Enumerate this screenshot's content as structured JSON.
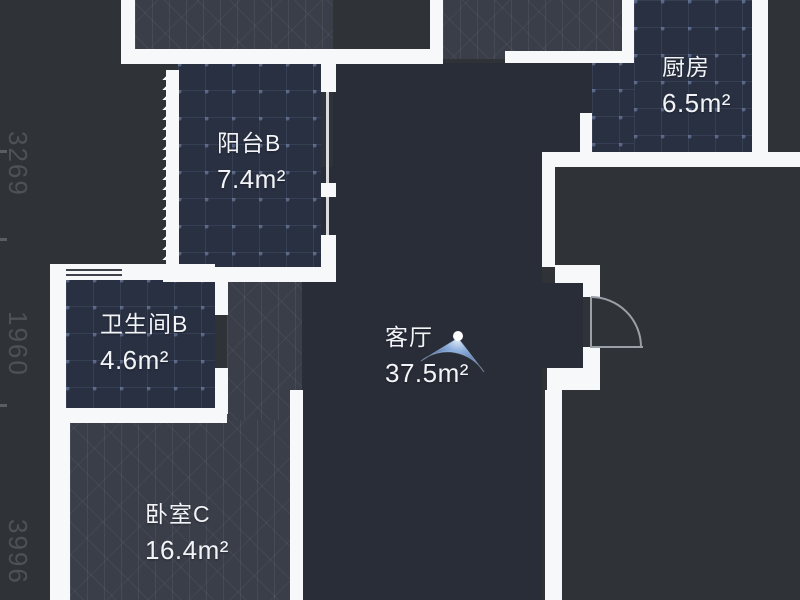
{
  "plan": {
    "rooms": [
      {
        "name": "阳台B",
        "area": "7.4m²"
      },
      {
        "name": "厨房",
        "area": "6.5m²"
      },
      {
        "name": "卫生间B",
        "area": "4.6m²"
      },
      {
        "name": "客厅",
        "area": "37.5m²"
      },
      {
        "name": "卧室C",
        "area": "16.4m²"
      }
    ],
    "dimensions_left": [
      "3269",
      "1960",
      "3996"
    ],
    "dimensions_right_clipped": [
      "6100",
      "350",
      "325"
    ],
    "colors": {
      "background": "#2f3236",
      "wall": "#f7f8f9",
      "tile_room_fill": "#293042",
      "wood_room_fill": "#3a3e49",
      "living_room_fill": "#292d38",
      "label_text": "#f2f4f7",
      "dimension_text": "#4e5157",
      "cone_blue": "#3c5f9a",
      "door_arc": "#9aa0a8"
    },
    "icons": [
      {
        "name": "panorama-viewpoint-cone"
      },
      {
        "name": "door-swing-arc"
      },
      {
        "name": "accordion-door"
      },
      {
        "name": "window-symbol"
      }
    ]
  }
}
